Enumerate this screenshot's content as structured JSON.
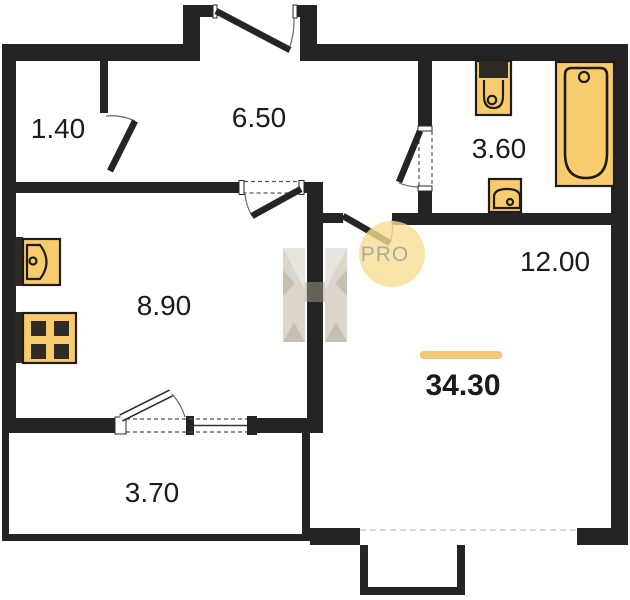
{
  "plan_title": "Apartment floor plan",
  "rooms": {
    "closet": {
      "area": "1.40"
    },
    "hallway": {
      "area": "6.50"
    },
    "bathroom": {
      "area": "3.60"
    },
    "kitchen": {
      "area": "8.90"
    },
    "living": {
      "area": "12.00"
    },
    "balcony": {
      "area": "3.70"
    }
  },
  "total_area": "34.30",
  "watermark": {
    "badge": "PRO"
  },
  "fixtures": [
    "kitchen-sink",
    "stove",
    "toilet",
    "bathroom-sink",
    "bathtub"
  ],
  "colors": {
    "wall": "#242424",
    "fixture_fill": "#F8CC6C",
    "fixture_stroke": "#1F1B16",
    "burner": "#2E2A26",
    "accent_bar": "#F2C979",
    "label_text": "#1B1B1B",
    "badge_fill": "#F6DD94",
    "badge_text": "#B1A89F",
    "logo_beige": "#D8D2C8",
    "logo_beige_light": "#E7E3DC",
    "logo_beige_dark": "#C2BAAD",
    "logo_overlay": "#A79C88"
  }
}
